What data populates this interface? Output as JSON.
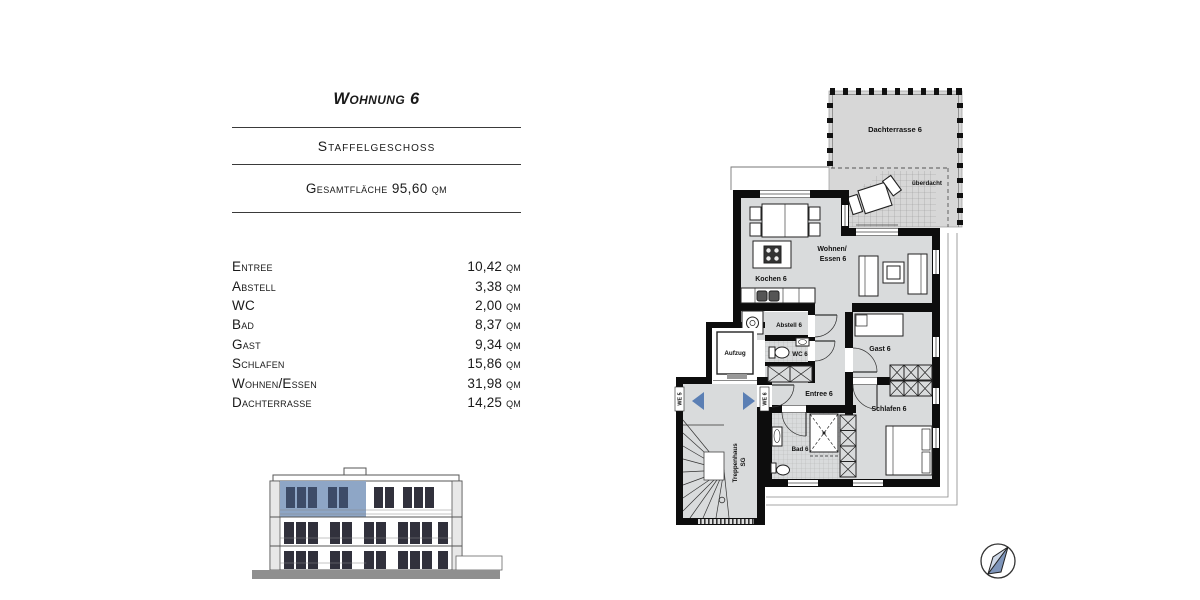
{
  "header": {
    "title": "Wohnung 6",
    "subtitle": "Staffelgeschoss",
    "total_area": "Gesamtfläche 95,60 qm"
  },
  "rooms": [
    {
      "label": "Entree",
      "area": "10,42 qm"
    },
    {
      "label": "Abstell",
      "area": "3,38 qm"
    },
    {
      "label": "WC",
      "area": "2,00 qm"
    },
    {
      "label": "Bad",
      "area": "8,37 qm"
    },
    {
      "label": "Gast",
      "area": "9,34 qm"
    },
    {
      "label": "Schlafen",
      "area": "15,86 qm"
    },
    {
      "label": "Wohnen/Essen",
      "area": "31,98 qm"
    },
    {
      "label": "Dachterrasse",
      "area": "14,25 qm"
    }
  ],
  "plan": {
    "labels": {
      "dachterrasse": "Dachterrasse 6",
      "ueberdacht": "überdacht",
      "wohnen_line1": "Wohnen/",
      "wohnen_line2": "Essen 6",
      "kochen": "Kochen 6",
      "abstell": "Abstell 6",
      "wc": "WC 6",
      "aufzug": "Aufzug",
      "entree": "Entree 6",
      "gast": "Gast 6",
      "schlafen": "Schlafen 6",
      "bad": "Bad 6",
      "treppenhaus_line1": "Treppenhaus",
      "treppenhaus_line2": "SG",
      "we5": "WE 5",
      "we6": "WE 6"
    },
    "colors": {
      "wall": "#0d0d0d",
      "room_fill": "#d9dbdc",
      "terrace_fill": "#d7d7d7",
      "accent_blue": "#5b7fb4"
    }
  },
  "elevation": {
    "highlight_color": "#8ea6c6"
  }
}
